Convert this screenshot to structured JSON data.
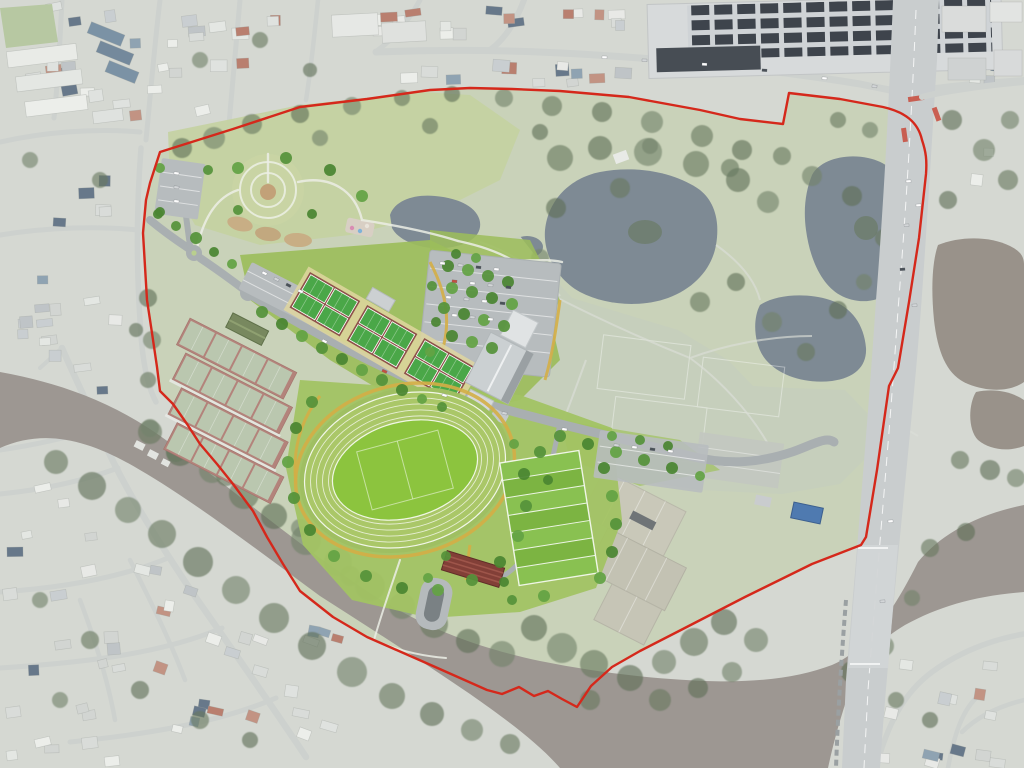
{
  "document": {
    "title": "Aerial master plan of riverside sports parklands with red site boundary",
    "type": "aerial-site-plan",
    "canvas_width": 1024,
    "canvas_height": 768
  },
  "colors": {
    "suburb_base": "#d5d8d2",
    "street": "#cdd1ce",
    "site_base": "#c9d2b9",
    "parkland_lawn": "#c4d2a1",
    "existing_field": "#c6cfbc",
    "bright_lawn": "#9cbd5b",
    "bright_lawn2": "#a2c363",
    "river": "#9d9792",
    "lake": "#7e8a94",
    "pond_brown": "#99928a",
    "tree_washed": "#68795f",
    "tree_new": "#55923a",
    "road_new": "#a9afb1",
    "parking": "#b7bcbe",
    "path_white": "#eceee6",
    "path_yellow": "#d4ae46",
    "court_green": "#4aa748",
    "court_surround": "#8d5149",
    "court_walk": "#e3d9a0",
    "tennis_court": "#bac7af",
    "tennis_surround": "#b3837b",
    "tennis_roof": "#78885f",
    "track_band": "#aac768",
    "track_infield": "#8cc43e",
    "rugby_green": "#7cb442",
    "rugby_stripe": "#89c151",
    "building_roof": "#cbd0d2",
    "building_dark": "#474d54",
    "grandstand": "#823f37",
    "highway": "#c9cdce",
    "solar": "#3e444c",
    "boundary": "#d5281b",
    "shelter_blue": "#4f7ab0",
    "hardcourt_old": "#c9c8b9"
  },
  "counts": {
    "netball_courts": 12,
    "tennis_courts": 16,
    "athletics_tracks": 1,
    "rugby_fields": 1,
    "roundabouts": 2
  },
  "features": [
    {
      "name": "site-boundary",
      "kind": "boundary-line"
    },
    {
      "name": "river",
      "kind": "waterway"
    },
    {
      "name": "lagoon-lakes",
      "kind": "water"
    },
    {
      "name": "northern-parkland-gardens",
      "kind": "open-space"
    },
    {
      "name": "circular-garden",
      "kind": "landscape-feature"
    },
    {
      "name": "netball-courts",
      "kind": "sports-courts"
    },
    {
      "name": "tennis-centre",
      "kind": "sports-courts"
    },
    {
      "name": "athletics-track",
      "kind": "sports-facility"
    },
    {
      "name": "rugby-field",
      "kind": "sports-field"
    },
    {
      "name": "existing-playing-fields",
      "kind": "open-space"
    },
    {
      "name": "existing-hard-courts",
      "kind": "sports-courts"
    },
    {
      "name": "indoor-sports-building",
      "kind": "building"
    },
    {
      "name": "grandstand",
      "kind": "building"
    },
    {
      "name": "car-park",
      "kind": "parking"
    },
    {
      "name": "entry-road-with-roundabouts",
      "kind": "road"
    },
    {
      "name": "shopping-centre-solar-roof",
      "kind": "building"
    },
    {
      "name": "highway-and-river-bridge",
      "kind": "road"
    },
    {
      "name": "suburban-housing",
      "kind": "context"
    }
  ]
}
